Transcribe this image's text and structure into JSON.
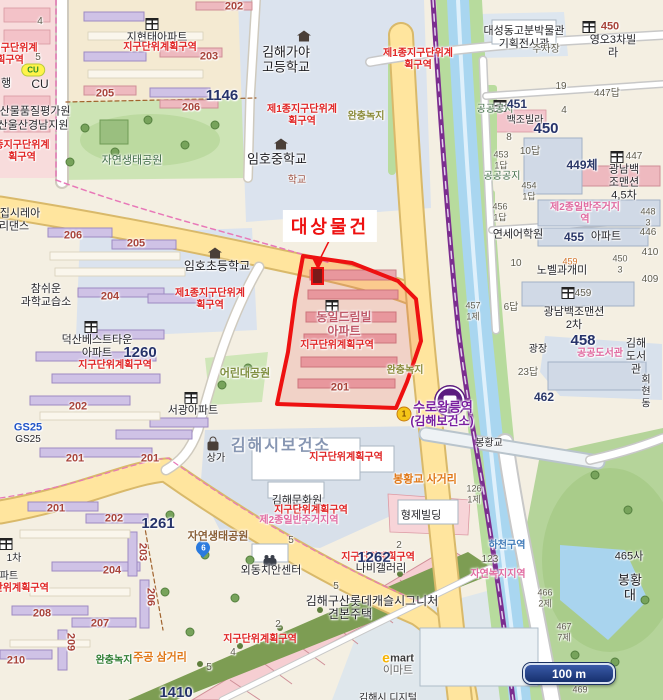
{
  "map": {
    "target": {
      "label": "대상물건"
    },
    "scale_bar": {
      "label": "100 m"
    },
    "colors": {
      "target_outline": "#ee1111",
      "district_text": "#e02424",
      "road_yellow": "#ffe59e",
      "stream_blue": "#a9d6f0",
      "rail_purple": "#7b2d8f"
    },
    "station": {
      "name": "수로왕릉역",
      "sub": "(김해보건소)",
      "line_badge": "1"
    },
    "labels": [
      {
        "t": "종지구단위계\n획구역",
        "x": 10,
        "y": 55,
        "c": "red",
        "s": 10
      },
      {
        "t": "4",
        "x": 40,
        "y": 22,
        "c": "par"
      },
      {
        "t": "5",
        "x": 38,
        "y": 58,
        "c": "par"
      },
      {
        "t": "행",
        "x": 6,
        "y": 84,
        "c": "k"
      },
      {
        "t": "5",
        "x": 12,
        "y": 158,
        "c": "par"
      },
      {
        "t": "CU",
        "x": 40,
        "y": 84,
        "c": "k",
        "s": 12
      },
      {
        "t": "축산물품질평가원",
        "x": 30,
        "y": 112,
        "c": "k"
      },
      {
        "t": "부산울산경남지원",
        "x": 28,
        "y": 126,
        "c": "k"
      },
      {
        "t": "종지구단위계\n획구역",
        "x": 22,
        "y": 152,
        "c": "red",
        "s": 10
      },
      {
        "t": "지현태아파트",
        "x": 157,
        "y": 38,
        "c": "k"
      },
      {
        "t": "지구단위계획구역",
        "x": 160,
        "y": 48,
        "c": "red",
        "s": 10
      },
      {
        "t": "202",
        "x": 234,
        "y": 7,
        "c": "blk"
      },
      {
        "t": "203",
        "x": 209,
        "y": 57,
        "c": "blk"
      },
      {
        "t": "1146",
        "x": 222,
        "y": 96,
        "c": "navyL"
      },
      {
        "t": "205",
        "x": 105,
        "y": 94,
        "c": "blk"
      },
      {
        "t": "206",
        "x": 191,
        "y": 108,
        "c": "blk"
      },
      {
        "t": "자연생태공원",
        "x": 132,
        "y": 161,
        "c": "greenD",
        "s": 11
      },
      {
        "t": "김해가야\n고등학교",
        "x": 286,
        "y": 60,
        "c": "kl"
      },
      {
        "t": "제1종지구단위계\n획구역",
        "x": 302,
        "y": 116,
        "c": "red",
        "s": 10
      },
      {
        "t": "완충녹지",
        "x": 366,
        "y": 117,
        "c": "olive"
      },
      {
        "t": "임호중학교",
        "x": 277,
        "y": 159,
        "c": "kl"
      },
      {
        "t": "학교",
        "x": 297,
        "y": 181,
        "c": "maroon"
      },
      {
        "t": "제1종지구단위계\n획구역",
        "x": 418,
        "y": 60,
        "c": "red",
        "s": 10
      },
      {
        "t": "대성동고분박물관\n기획전시관",
        "x": 524,
        "y": 38,
        "c": "k"
      },
      {
        "t": "주차장",
        "x": 546,
        "y": 50,
        "c": "par"
      },
      {
        "t": "영오3차빌라",
        "x": 613,
        "y": 47,
        "c": "k"
      },
      {
        "t": "450",
        "x": 610,
        "y": 27,
        "c": "blk"
      },
      {
        "t": "447답",
        "x": 607,
        "y": 94,
        "c": "par"
      },
      {
        "t": "19",
        "x": 561,
        "y": 87,
        "c": "par"
      },
      {
        "t": "4",
        "x": 564,
        "y": 111,
        "c": "par"
      },
      {
        "t": "공공공지",
        "x": 495,
        "y": 110,
        "c": "greenD"
      },
      {
        "t": "451",
        "x": 517,
        "y": 104,
        "c": "navy"
      },
      {
        "t": "백조빌라",
        "x": 525,
        "y": 121,
        "c": "k",
        "s": 10
      },
      {
        "t": "450",
        "x": 546,
        "y": 129,
        "c": "navyL"
      },
      {
        "t": "8",
        "x": 509,
        "y": 138,
        "c": "par"
      },
      {
        "t": "10답",
        "x": 530,
        "y": 152,
        "c": "par"
      },
      {
        "t": "453\n1답",
        "x": 501,
        "y": 160,
        "c": "par",
        "s": 9
      },
      {
        "t": "449체",
        "x": 582,
        "y": 165,
        "c": "navy"
      },
      {
        "t": "447",
        "x": 634,
        "y": 157,
        "c": "par"
      },
      {
        "t": "광남백조맨션\n4,5차",
        "x": 624,
        "y": 183,
        "c": "k"
      },
      {
        "t": "454\n1답",
        "x": 529,
        "y": 191,
        "c": "par",
        "s": 9
      },
      {
        "t": "공공공지",
        "x": 502,
        "y": 177,
        "c": "greenD"
      },
      {
        "t": "456\n1답",
        "x": 500,
        "y": 212,
        "c": "par",
        "s": 9
      },
      {
        "t": "제2종일반주거지역",
        "x": 585,
        "y": 214,
        "c": "pink"
      },
      {
        "t": "448\n3",
        "x": 648,
        "y": 217,
        "c": "par",
        "s": 9
      },
      {
        "t": "446",
        "x": 648,
        "y": 233,
        "c": "par"
      },
      {
        "t": "연세어학원",
        "x": 518,
        "y": 235,
        "c": "k"
      },
      {
        "t": "455",
        "x": 574,
        "y": 237,
        "c": "navy"
      },
      {
        "t": "아파트",
        "x": 606,
        "y": 237,
        "c": "k"
      },
      {
        "t": "410",
        "x": 650,
        "y": 253,
        "c": "par"
      },
      {
        "t": "459",
        "x": 570,
        "y": 262,
        "c": "orgS"
      },
      {
        "t": "450\n3",
        "x": 620,
        "y": 264,
        "c": "par",
        "s": 9
      },
      {
        "t": "10",
        "x": 516,
        "y": 264,
        "c": "par"
      },
      {
        "t": "노벨과개미",
        "x": 562,
        "y": 271,
        "c": "k"
      },
      {
        "t": "409",
        "x": 650,
        "y": 280,
        "c": "par"
      },
      {
        "t": "457\n1제",
        "x": 473,
        "y": 311,
        "c": "par",
        "s": 9
      },
      {
        "t": "6답",
        "x": 511,
        "y": 308,
        "c": "par"
      },
      {
        "t": "459",
        "x": 583,
        "y": 294,
        "c": "par"
      },
      {
        "t": "광남백조맨션\n2차",
        "x": 574,
        "y": 319,
        "c": "k"
      },
      {
        "t": "458",
        "x": 583,
        "y": 341,
        "c": "navyL"
      },
      {
        "t": "광장",
        "x": 538,
        "y": 350,
        "c": "k",
        "s": 10
      },
      {
        "t": "공공도서관",
        "x": 600,
        "y": 354,
        "c": "pink"
      },
      {
        "t": "김해도서관",
        "x": 636,
        "y": 357,
        "c": "k"
      },
      {
        "t": "회현동",
        "x": 646,
        "y": 392,
        "c": "k",
        "s": 10
      },
      {
        "t": "23답",
        "x": 528,
        "y": 373,
        "c": "par"
      },
      {
        "t": "462",
        "x": 544,
        "y": 397,
        "c": "navy"
      },
      {
        "t": "완충녹지",
        "x": 405,
        "y": 371,
        "c": "olive"
      },
      {
        "t": "봉황교",
        "x": 489,
        "y": 444,
        "c": "k",
        "s": 10
      },
      {
        "t": "봉황교 사거리",
        "x": 425,
        "y": 480,
        "c": "org"
      },
      {
        "t": "126\n1제",
        "x": 474,
        "y": 494,
        "c": "par",
        "s": 9
      },
      {
        "t": "형제빌딩",
        "x": 421,
        "y": 516,
        "c": "k"
      },
      {
        "t": "하천구역",
        "x": 507,
        "y": 546,
        "c": "blue"
      },
      {
        "t": "123",
        "x": 490,
        "y": 560,
        "c": "par"
      },
      {
        "t": "자연녹지지역",
        "x": 498,
        "y": 575,
        "c": "pink"
      },
      {
        "t": "465사",
        "x": 629,
        "y": 557,
        "c": "k"
      },
      {
        "t": "봉황대",
        "x": 630,
        "y": 588,
        "c": "kl"
      },
      {
        "t": "466\n2제",
        "x": 545,
        "y": 598,
        "c": "par",
        "s": 9
      },
      {
        "t": "467\n7제",
        "x": 564,
        "y": 632,
        "c": "par",
        "s": 9
      },
      {
        "t": "469",
        "x": 580,
        "y": 690,
        "c": "par",
        "s": 9
      },
      {
        "t": "수로왕릉역",
        "x": 443,
        "y": 407,
        "c": "purple"
      },
      {
        "t": "(김해보건소)",
        "x": 442,
        "y": 421,
        "c": "purple",
        "s": 12
      },
      {
        "t": "집시레아",
        "x": 20,
        "y": 214,
        "c": "k"
      },
      {
        "t": "리댄스",
        "x": 14,
        "y": 227,
        "c": "k"
      },
      {
        "t": "206",
        "x": 73,
        "y": 236,
        "c": "blk"
      },
      {
        "t": "205",
        "x": 136,
        "y": 244,
        "c": "blk"
      },
      {
        "t": "임호초등학교",
        "x": 217,
        "y": 266,
        "c": "kl",
        "s": 12
      },
      {
        "t": "제1종지구단위계\n획구역",
        "x": 210,
        "y": 300,
        "c": "red",
        "s": 10
      },
      {
        "t": "참쉬운\n과학교습소",
        "x": 46,
        "y": 296,
        "c": "k"
      },
      {
        "t": "204",
        "x": 110,
        "y": 297,
        "c": "blk"
      },
      {
        "t": "덕산베스트타운\n아파트",
        "x": 97,
        "y": 347,
        "c": "k"
      },
      {
        "t": "1260",
        "x": 140,
        "y": 353,
        "c": "navyL"
      },
      {
        "t": "지구단위계획구역",
        "x": 115,
        "y": 366,
        "c": "red",
        "s": 10
      },
      {
        "t": "202",
        "x": 78,
        "y": 407,
        "c": "blk"
      },
      {
        "t": "서광아파트",
        "x": 193,
        "y": 411,
        "c": "k"
      },
      {
        "t": "201",
        "x": 75,
        "y": 459,
        "c": "blk"
      },
      {
        "t": "201",
        "x": 150,
        "y": 459,
        "c": "blk"
      },
      {
        "t": "상가",
        "x": 216,
        "y": 459,
        "c": "k",
        "s": 10
      },
      {
        "t": "어린대공원",
        "x": 245,
        "y": 374,
        "c": "oliveG"
      },
      {
        "t": "201",
        "x": 56,
        "y": 509,
        "c": "blk"
      },
      {
        "t": "202",
        "x": 114,
        "y": 519,
        "c": "blk"
      },
      {
        "t": "1261",
        "x": 158,
        "y": 524,
        "c": "navyL"
      },
      {
        "t": "203",
        "x": 142,
        "y": 552,
        "c": "blk",
        "r": 90
      },
      {
        "t": "204",
        "x": 112,
        "y": 571,
        "c": "blk"
      },
      {
        "t": "206",
        "x": 150,
        "y": 597,
        "c": "blk",
        "r": 90
      },
      {
        "t": "208",
        "x": 42,
        "y": 614,
        "c": "blk"
      },
      {
        "t": "207",
        "x": 100,
        "y": 624,
        "c": "blk"
      },
      {
        "t": "209",
        "x": 70,
        "y": 642,
        "c": "blk",
        "r": 90
      },
      {
        "t": "210",
        "x": 16,
        "y": 661,
        "c": "blk"
      },
      {
        "t": "1차",
        "x": 14,
        "y": 559,
        "c": "k",
        "s": 10
      },
      {
        "t": "파트",
        "x": 9,
        "y": 577,
        "c": "k",
        "s": 10
      },
      {
        "t": "지구단위계획구역",
        "x": 12,
        "y": 589,
        "c": "red",
        "s": 10
      },
      {
        "t": "자연생태공원",
        "x": 218,
        "y": 537,
        "c": "brown"
      },
      {
        "t": "김해시보건소",
        "x": 281,
        "y": 447,
        "c": "health"
      },
      {
        "t": "지구단위계획구역",
        "x": 346,
        "y": 458,
        "c": "red",
        "s": 10
      },
      {
        "t": "김해문화원",
        "x": 297,
        "y": 501,
        "c": "k"
      },
      {
        "t": "지구단위계획구역",
        "x": 311,
        "y": 511,
        "c": "red",
        "s": 10
      },
      {
        "t": "제2종일반주거지역",
        "x": 299,
        "y": 521,
        "c": "pink"
      },
      {
        "t": "외동치안센터",
        "x": 271,
        "y": 571,
        "c": "k"
      },
      {
        "t": "지구단위계획구역",
        "x": 378,
        "y": 558,
        "c": "red",
        "s": 10
      },
      {
        "t": "1262",
        "x": 374,
        "y": 558,
        "c": "navyL"
      },
      {
        "t": "나비갤러리",
        "x": 381,
        "y": 569,
        "c": "k"
      },
      {
        "t": "김해구산롯데캐슬시그니처",
        "x": 372,
        "y": 601,
        "c": "k",
        "s": 12
      },
      {
        "t": "견본주택",
        "x": 350,
        "y": 614,
        "c": "k",
        "s": 12
      },
      {
        "t": "지구단위계획구역",
        "x": 260,
        "y": 640,
        "c": "red",
        "s": 10
      },
      {
        "t": "주공 삼거리",
        "x": 160,
        "y": 658,
        "c": "org"
      },
      {
        "t": "완충녹지",
        "x": 114,
        "y": 661,
        "c": "green",
        "s": 10
      },
      {
        "t": "1410",
        "x": 176,
        "y": 693,
        "c": "navyL"
      },
      {
        "t": "5",
        "x": 291,
        "y": 541,
        "c": "par"
      },
      {
        "t": "2",
        "x": 399,
        "y": 546,
        "c": "par"
      },
      {
        "t": "5",
        "x": 336,
        "y": 587,
        "c": "par"
      },
      {
        "t": "2",
        "x": 278,
        "y": 625,
        "c": "par"
      },
      {
        "t": "4",
        "x": 233,
        "y": 653,
        "c": "par"
      },
      {
        "t": "5",
        "x": 209,
        "y": 668,
        "c": "par"
      },
      {
        "t": "동일드림빌\n아파트",
        "x": 344,
        "y": 324,
        "c": "rose"
      },
      {
        "t": "지구단위계획구역",
        "x": 337,
        "y": 346,
        "c": "red",
        "s": 10
      },
      {
        "t": "201",
        "x": 340,
        "y": 388,
        "c": "blk"
      },
      {
        "t": "GS25",
        "x": 28,
        "y": 428,
        "c": "gs"
      },
      {
        "t": "GS25",
        "x": 28,
        "y": 440,
        "c": "k",
        "s": 10
      },
      {
        "t": "e",
        "x": 386,
        "y": 658,
        "c": "em-e"
      },
      {
        "t": "mart",
        "x": 402,
        "y": 659,
        "c": "em-m"
      },
      {
        "t": "이마트",
        "x": 398,
        "y": 671,
        "c": "gray",
        "s": 11
      },
      {
        "t": "김해시 디지털",
        "x": 388,
        "y": 699,
        "c": "k",
        "s": 10
      }
    ],
    "icons": [
      {
        "type": "apartment",
        "x": 152,
        "y": 24
      },
      {
        "type": "apartment",
        "x": 589,
        "y": 27
      },
      {
        "type": "apartment",
        "x": 500,
        "y": 106
      },
      {
        "type": "apartment",
        "x": 617,
        "y": 157
      },
      {
        "type": "apartment",
        "x": 568,
        "y": 293
      },
      {
        "type": "apartment",
        "x": 332,
        "y": 306
      },
      {
        "type": "apartment",
        "x": 91,
        "y": 327
      },
      {
        "type": "apartment",
        "x": 191,
        "y": 398
      },
      {
        "type": "apartment",
        "x": 6,
        "y": 544
      },
      {
        "type": "school",
        "x": 304,
        "y": 36
      },
      {
        "type": "school",
        "x": 281,
        "y": 144
      },
      {
        "type": "school",
        "x": 215,
        "y": 253
      },
      {
        "type": "bag",
        "x": 213,
        "y": 446
      },
      {
        "type": "police",
        "x": 270,
        "y": 553
      },
      {
        "type": "pin6",
        "x": 203,
        "y": 552,
        "text": "6"
      },
      {
        "type": "badge1",
        "x": 404,
        "y": 414,
        "text": "1"
      },
      {
        "type": "cubadge",
        "x": 33,
        "y": 70,
        "text": "CU"
      },
      {
        "type": "station",
        "x": 450,
        "y": 384
      }
    ]
  }
}
